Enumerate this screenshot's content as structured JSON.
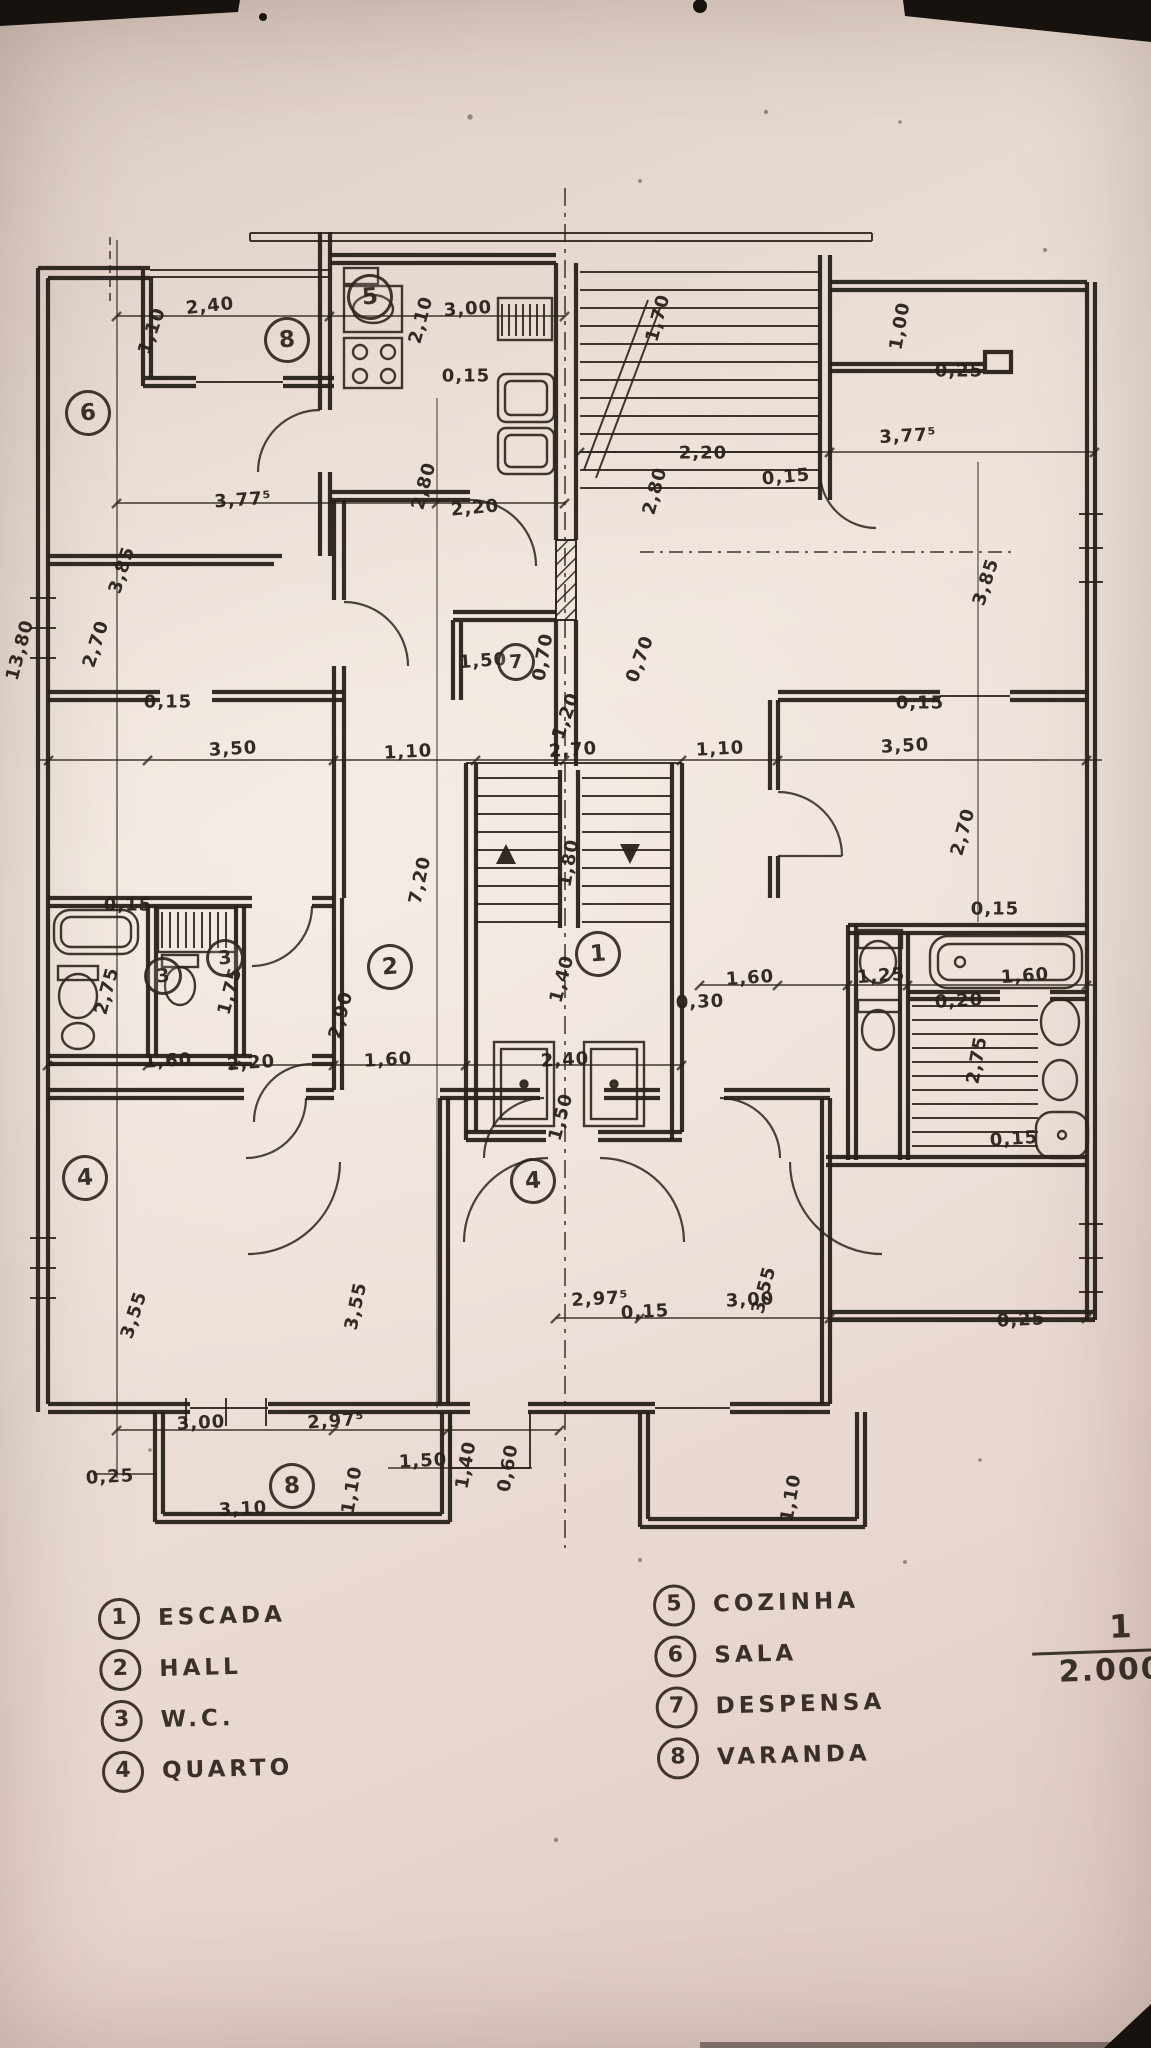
{
  "title": "hand-drawn apartment floor plan, scale 1/2.000",
  "colors": {
    "paper": "#e9dcd4",
    "ink": "#2c241c",
    "photo_mark": "#17120d"
  },
  "scale": {
    "numerator": "1",
    "denominator": "2.000"
  },
  "legend": {
    "left": [
      {
        "num": "1",
        "label": "ESCADA"
      },
      {
        "num": "2",
        "label": "HALL"
      },
      {
        "num": "3",
        "label": "W.C."
      },
      {
        "num": "4",
        "label": "QUARTO"
      }
    ],
    "right": [
      {
        "num": "5",
        "label": "COZINHA"
      },
      {
        "num": "6",
        "label": "SALA"
      },
      {
        "num": "7",
        "label": "DESPENSA"
      },
      {
        "num": "8",
        "label": "VARANDA"
      }
    ]
  },
  "room_markers": [
    {
      "num": "6",
      "x": 88,
      "y": 413
    },
    {
      "num": "8",
      "x": 287,
      "y": 340
    },
    {
      "num": "5",
      "x": 370,
      "y": 297
    },
    {
      "num": "7",
      "x": 516,
      "y": 662,
      "small": true
    },
    {
      "num": "1",
      "x": 598,
      "y": 954
    },
    {
      "num": "2",
      "x": 390,
      "y": 967
    },
    {
      "num": "3",
      "x": 163,
      "y": 976,
      "small": true
    },
    {
      "num": "3",
      "x": 225,
      "y": 958,
      "small": true
    },
    {
      "num": "4",
      "x": 85,
      "y": 1178
    },
    {
      "num": "4",
      "x": 533,
      "y": 1181
    },
    {
      "num": "8",
      "x": 292,
      "y": 1486
    }
  ],
  "dimensions": [
    {
      "text": "2,40",
      "x": 210,
      "y": 306,
      "rot": -6
    },
    {
      "text": "1,10",
      "x": 152,
      "y": 331,
      "rot": -70
    },
    {
      "text": "3,00",
      "x": 468,
      "y": 309,
      "rot": -4
    },
    {
      "text": "2,10",
      "x": 421,
      "y": 320,
      "rot": -75
    },
    {
      "text": "0,15",
      "x": 466,
      "y": 376,
      "rot": 0
    },
    {
      "text": "1,70",
      "x": 658,
      "y": 318,
      "rot": -75
    },
    {
      "text": "1,00",
      "x": 900,
      "y": 326,
      "rot": -80
    },
    {
      "text": "0,25",
      "x": 959,
      "y": 371,
      "rot": 0
    },
    {
      "text": "2,20",
      "x": 703,
      "y": 453,
      "rot": 0
    },
    {
      "text": "0,15",
      "x": 786,
      "y": 477,
      "rot": -5
    },
    {
      "text": "3,77⁵",
      "x": 908,
      "y": 436,
      "rot": -3
    },
    {
      "text": "3,77⁵",
      "x": 243,
      "y": 500,
      "rot": -4
    },
    {
      "text": "2,20",
      "x": 475,
      "y": 508,
      "rot": -5
    },
    {
      "text": "2,80",
      "x": 424,
      "y": 486,
      "rot": -75
    },
    {
      "text": "2,80",
      "x": 655,
      "y": 491,
      "rot": -75
    },
    {
      "text": "3,85",
      "x": 122,
      "y": 570,
      "rot": -72
    },
    {
      "text": "3,85",
      "x": 986,
      "y": 582,
      "rot": -72
    },
    {
      "text": "1,50",
      "x": 483,
      "y": 661,
      "rot": -4
    },
    {
      "text": "0,70",
      "x": 543,
      "y": 657,
      "rot": -80
    },
    {
      "text": "0,70",
      "x": 640,
      "y": 659,
      "rot": -70
    },
    {
      "text": "0,15",
      "x": 168,
      "y": 702,
      "rot": 0
    },
    {
      "text": "0,15",
      "x": 920,
      "y": 703,
      "rot": 0
    },
    {
      "text": "3,50",
      "x": 233,
      "y": 749,
      "rot": -3
    },
    {
      "text": "1,10",
      "x": 408,
      "y": 752,
      "rot": -3
    },
    {
      "text": "2,70",
      "x": 573,
      "y": 750,
      "rot": -4
    },
    {
      "text": "1,20",
      "x": 566,
      "y": 716,
      "rot": -70
    },
    {
      "text": "1,10",
      "x": 720,
      "y": 749,
      "rot": -3
    },
    {
      "text": "3,50",
      "x": 905,
      "y": 746,
      "rot": -3
    },
    {
      "text": "13,80",
      "x": 20,
      "y": 650,
      "rot": -75
    },
    {
      "text": "2,70",
      "x": 96,
      "y": 644,
      "rot": -72
    },
    {
      "text": "2,70",
      "x": 963,
      "y": 832,
      "rot": -75
    },
    {
      "text": "7,20",
      "x": 420,
      "y": 880,
      "rot": -78
    },
    {
      "text": "1,80",
      "x": 569,
      "y": 863,
      "rot": -80
    },
    {
      "text": "0,15",
      "x": 128,
      "y": 905,
      "rot": 0
    },
    {
      "text": "0,15",
      "x": 995,
      "y": 909,
      "rot": 0
    },
    {
      "text": "1,40",
      "x": 562,
      "y": 979,
      "rot": -75
    },
    {
      "text": "2,90",
      "x": 341,
      "y": 1015,
      "rot": -75
    },
    {
      "text": "2,75",
      "x": 107,
      "y": 991,
      "rot": -75
    },
    {
      "text": "1,75",
      "x": 230,
      "y": 991,
      "rot": -75
    },
    {
      "text": "1,60",
      "x": 168,
      "y": 1061,
      "rot": -3
    },
    {
      "text": "2,20",
      "x": 251,
      "y": 1063,
      "rot": -4
    },
    {
      "text": "1,60",
      "x": 388,
      "y": 1060,
      "rot": -3
    },
    {
      "text": "2,40",
      "x": 565,
      "y": 1060,
      "rot": -3
    },
    {
      "text": "1,50",
      "x": 561,
      "y": 1117,
      "rot": -75
    },
    {
      "text": "1,60",
      "x": 750,
      "y": 978,
      "rot": -4
    },
    {
      "text": "1,25",
      "x": 881,
      "y": 976,
      "rot": -4
    },
    {
      "text": "1,60",
      "x": 1025,
      "y": 976,
      "rot": -4
    },
    {
      "text": "0,30",
      "x": 700,
      "y": 1002,
      "rot": -2
    },
    {
      "text": "0,20",
      "x": 959,
      "y": 1001,
      "rot": -3
    },
    {
      "text": "2,75",
      "x": 977,
      "y": 1060,
      "rot": -80
    },
    {
      "text": "0,15",
      "x": 1014,
      "y": 1139,
      "rot": -4
    },
    {
      "text": "3,55",
      "x": 134,
      "y": 1315,
      "rot": -72
    },
    {
      "text": "3,55",
      "x": 356,
      "y": 1306,
      "rot": -78
    },
    {
      "text": "3,55",
      "x": 764,
      "y": 1290,
      "rot": -75
    },
    {
      "text": "2,97⁵",
      "x": 600,
      "y": 1299,
      "rot": -3
    },
    {
      "text": "0,15",
      "x": 645,
      "y": 1312,
      "rot": -3
    },
    {
      "text": "3,00",
      "x": 750,
      "y": 1300,
      "rot": -3
    },
    {
      "text": "0,25",
      "x": 1021,
      "y": 1320,
      "rot": -3
    },
    {
      "text": "3,00",
      "x": 201,
      "y": 1423,
      "rot": -3
    },
    {
      "text": "2,97⁵",
      "x": 336,
      "y": 1421,
      "rot": -4
    },
    {
      "text": "0,25",
      "x": 110,
      "y": 1477,
      "rot": -3
    },
    {
      "text": "3,10",
      "x": 243,
      "y": 1509,
      "rot": -3
    },
    {
      "text": "1,10",
      "x": 352,
      "y": 1490,
      "rot": -80
    },
    {
      "text": "1,50",
      "x": 423,
      "y": 1461,
      "rot": -3
    },
    {
      "text": "1,40",
      "x": 466,
      "y": 1465,
      "rot": -80
    },
    {
      "text": "0,60",
      "x": 508,
      "y": 1468,
      "rot": -80
    },
    {
      "text": "1,10",
      "x": 791,
      "y": 1498,
      "rot": -80
    }
  ]
}
